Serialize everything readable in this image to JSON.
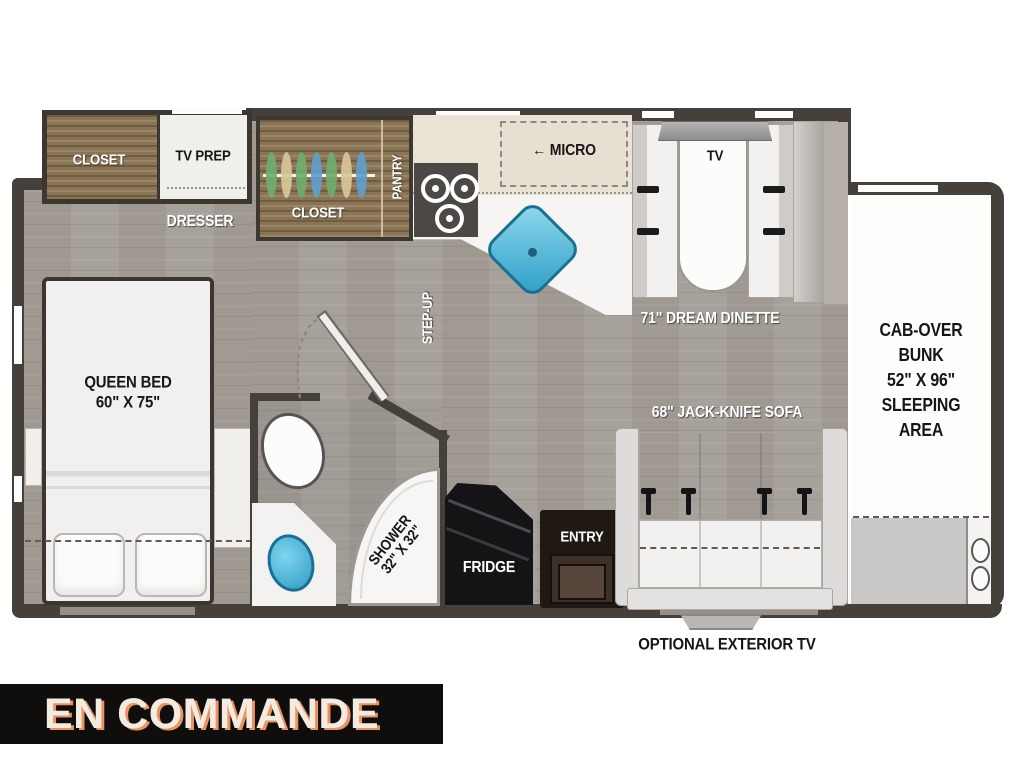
{
  "banner": {
    "label": "EN COMMANDE"
  },
  "labels": {
    "closet_bedroom": "CLOSET",
    "tv_prep": "TV PREP",
    "dresser": "DRESSER",
    "closet_wardrobe": "CLOSET",
    "pantry": "PANTRY",
    "micro_arrow": "←",
    "micro": "MICRO",
    "step_up": "STEP-UP",
    "tv": "TV",
    "dinette": "71\" DREAM DINETTE",
    "sofa": "68\" JACK-KNIFE SOFA",
    "fridge": "FRIDGE",
    "entry": "ENTRY",
    "queen_bed_line1": "QUEEN BED",
    "queen_bed_line2": "60\" X 75\"",
    "shower_line1": "SHOWER",
    "shower_line2": "32\" X 32\"",
    "cab_over_lines": [
      "CAB-OVER",
      "BUNK",
      "52\" X 96\"",
      "SLEEPING",
      "AREA"
    ],
    "optional_exterior_tv": "OPTIONAL EXTERIOR TV"
  },
  "colors": {
    "wall": "#46403a",
    "floor": "#a49e97",
    "wood": "#8a7456",
    "sink_blue": "#3aa9d0",
    "banner_bg": "#0f0e0c",
    "banner_text": "#f2ebe1",
    "banner_shadow": "#eb9261"
  }
}
